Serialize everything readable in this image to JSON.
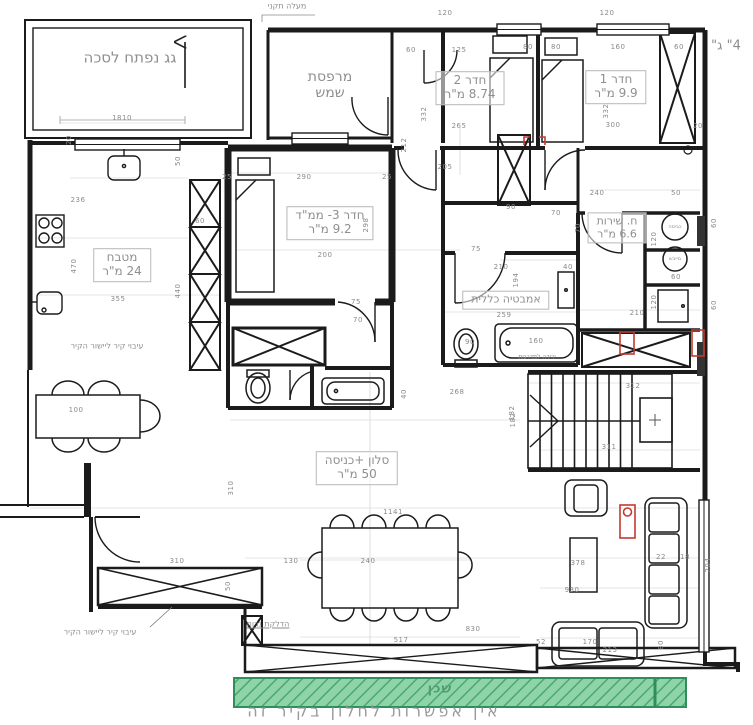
{
  "drawing": {
    "type": "apartment-floor-plan",
    "colors": {
      "wall": "#1b1b1b",
      "dim_text": "#8a8a8a",
      "label_text": "#8f8f8f",
      "red_marker": "#c23b2e",
      "green_fill": "#8fd4a8",
      "green_hatch": "#4aa870",
      "green_border": "#2f8f5b"
    },
    "rooms": [
      {
        "id": "roof-terrace",
        "line1": "גג נפתח לסכה",
        "line2": "",
        "x": 130,
        "y": 58,
        "size": 15,
        "boxed": false
      },
      {
        "id": "sun-balcony",
        "line1": "מרפסת",
        "line2": "שמש",
        "x": 330,
        "y": 85,
        "size": 14,
        "boxed": false
      },
      {
        "id": "room-2",
        "line1": "חדר 2",
        "line2": "8.74 מ\"ר",
        "x": 470,
        "y": 88,
        "size": 12,
        "boxed": true
      },
      {
        "id": "room-1",
        "line1": "חדר 1",
        "line2": "9.9 מ\"ר",
        "x": 616,
        "y": 87,
        "size": 12,
        "boxed": true
      },
      {
        "id": "kitchen",
        "line1": "מטבח",
        "line2": "24 מ\"ר",
        "x": 122,
        "y": 265,
        "size": 12,
        "boxed": true
      },
      {
        "id": "room-3-mamad",
        "line1": "חדר 3- ממ\"ד",
        "line2": "9.2 מ\"ר",
        "x": 330,
        "y": 223,
        "size": 12,
        "boxed": true
      },
      {
        "id": "bathroom",
        "line1": "אמבטיה כללית",
        "line2": "",
        "x": 506,
        "y": 300,
        "size": 11,
        "boxed": true
      },
      {
        "id": "service-room",
        "line1": "ח. שירות",
        "line2": "6.6 מ\"ר",
        "x": 617,
        "y": 228,
        "size": 11,
        "boxed": true
      },
      {
        "id": "living-entrance",
        "line1": "סלון +כניסה",
        "line2": "50 מ\"ר",
        "x": 357,
        "y": 468,
        "size": 12,
        "boxed": true
      }
    ],
    "annotations": [
      {
        "id": "standard-access",
        "text": "מעלה תקני",
        "x": 287,
        "y": 6,
        "size": 8,
        "cls": ""
      },
      {
        "id": "pipe-4-inch",
        "text": "4\" ג\"",
        "x": 726,
        "y": 46,
        "size": 13,
        "cls": ""
      },
      {
        "id": "wall-thickening-1",
        "text": "עיבוי קיר ליישור הקיר",
        "x": 107,
        "y": 346,
        "size": 8,
        "cls": ""
      },
      {
        "id": "wall-thickening-2",
        "text": "עיבוי קיר ליישור הקיר",
        "x": 100,
        "y": 632,
        "size": 8,
        "cls": ""
      },
      {
        "id": "candle-lighting",
        "text": "הדלקת נרות",
        "x": 268,
        "y": 624,
        "size": 8,
        "cls": "underline"
      },
      {
        "id": "stairs-note",
        "text": "ירידה למדרגות",
        "x": 537,
        "y": 357,
        "size": 6,
        "cls": ""
      },
      {
        "id": "washing-machine",
        "text": "כביסה",
        "x": 675,
        "y": 227,
        "size": 5,
        "cls": ""
      },
      {
        "id": "dryer",
        "text": "מייבש",
        "x": 675,
        "y": 259,
        "size": 5,
        "cls": ""
      },
      {
        "id": "neighbor",
        "text": "שכן",
        "x": 440,
        "y": 689,
        "size": 13,
        "cls": "green"
      },
      {
        "id": "no-window-note",
        "text": "אין אפשרות לחלון בקיר זה",
        "x": 374,
        "y": 711,
        "size": 16,
        "cls": "big"
      }
    ],
    "dims": [
      [
        122,
        118,
        "1810",
        0
      ],
      [
        445,
        13,
        "120",
        0
      ],
      [
        607,
        13,
        "120",
        0
      ],
      [
        411,
        50,
        "60",
        0
      ],
      [
        459,
        50,
        "125",
        0
      ],
      [
        528,
        47,
        "80",
        0
      ],
      [
        556,
        47,
        "80",
        0
      ],
      [
        618,
        47,
        "160",
        0
      ],
      [
        679,
        47,
        "60",
        0
      ],
      [
        459,
        126,
        "265",
        0
      ],
      [
        424,
        114,
        "332",
        1
      ],
      [
        404,
        145,
        "212",
        1
      ],
      [
        613,
        125,
        "300",
        0
      ],
      [
        606,
        111,
        "332",
        1
      ],
      [
        698,
        126,
        "20",
        0
      ],
      [
        69,
        140,
        "20",
        1
      ],
      [
        78,
        200,
        "236",
        0
      ],
      [
        74,
        266,
        "470",
        1
      ],
      [
        118,
        299,
        "355",
        0
      ],
      [
        178,
        291,
        "440",
        1
      ],
      [
        178,
        161,
        "50",
        1
      ],
      [
        200,
        221,
        "60",
        0
      ],
      [
        304,
        177,
        "290",
        0
      ],
      [
        227,
        177,
        "25",
        0
      ],
      [
        387,
        177,
        "25",
        0
      ],
      [
        366,
        225,
        "298",
        1
      ],
      [
        325,
        255,
        "200",
        0
      ],
      [
        356,
        302,
        "75",
        0
      ],
      [
        358,
        320,
        "70",
        0
      ],
      [
        445,
        167,
        "205",
        0
      ],
      [
        511,
        207,
        "90",
        0
      ],
      [
        556,
        213,
        "70",
        0
      ],
      [
        476,
        249,
        "75",
        0
      ],
      [
        597,
        193,
        "240",
        0
      ],
      [
        676,
        193,
        "50",
        0
      ],
      [
        501,
        267,
        "210",
        0
      ],
      [
        568,
        267,
        "40",
        0
      ],
      [
        504,
        315,
        "259",
        0
      ],
      [
        536,
        341,
        "160",
        0
      ],
      [
        470,
        342,
        "90",
        0
      ],
      [
        516,
        280,
        "194",
        1
      ],
      [
        578,
        228,
        "70",
        1
      ],
      [
        654,
        239,
        "120",
        1
      ],
      [
        676,
        277,
        "60",
        0
      ],
      [
        654,
        302,
        "120",
        1
      ],
      [
        637,
        313,
        "210",
        0
      ],
      [
        714,
        223,
        "60",
        1
      ],
      [
        714,
        305,
        "60",
        1
      ],
      [
        633,
        386,
        "312",
        0
      ],
      [
        609,
        447,
        "311",
        0
      ],
      [
        512,
        413,
        "182",
        1
      ],
      [
        457,
        392,
        "268",
        0
      ],
      [
        513,
        420,
        "182",
        1
      ],
      [
        393,
        512,
        "1141",
        0
      ],
      [
        404,
        394,
        "40",
        1
      ],
      [
        368,
        561,
        "240",
        0
      ],
      [
        578,
        563,
        "378",
        0
      ],
      [
        473,
        629,
        "830",
        0
      ],
      [
        401,
        640,
        "517",
        0
      ],
      [
        572,
        590,
        "930",
        0
      ],
      [
        708,
        565,
        "204",
        1
      ],
      [
        661,
        557,
        "22",
        0
      ],
      [
        685,
        557,
        "18",
        0
      ],
      [
        590,
        642,
        "170",
        0
      ],
      [
        541,
        642,
        "52",
        0
      ],
      [
        610,
        650,
        "213",
        0
      ],
      [
        661,
        645,
        "80",
        1
      ],
      [
        76,
        410,
        "100",
        0
      ],
      [
        231,
        488,
        "310",
        1
      ],
      [
        177,
        561,
        "310",
        0
      ],
      [
        291,
        561,
        "130",
        0
      ],
      [
        228,
        586,
        "50",
        1
      ]
    ]
  }
}
